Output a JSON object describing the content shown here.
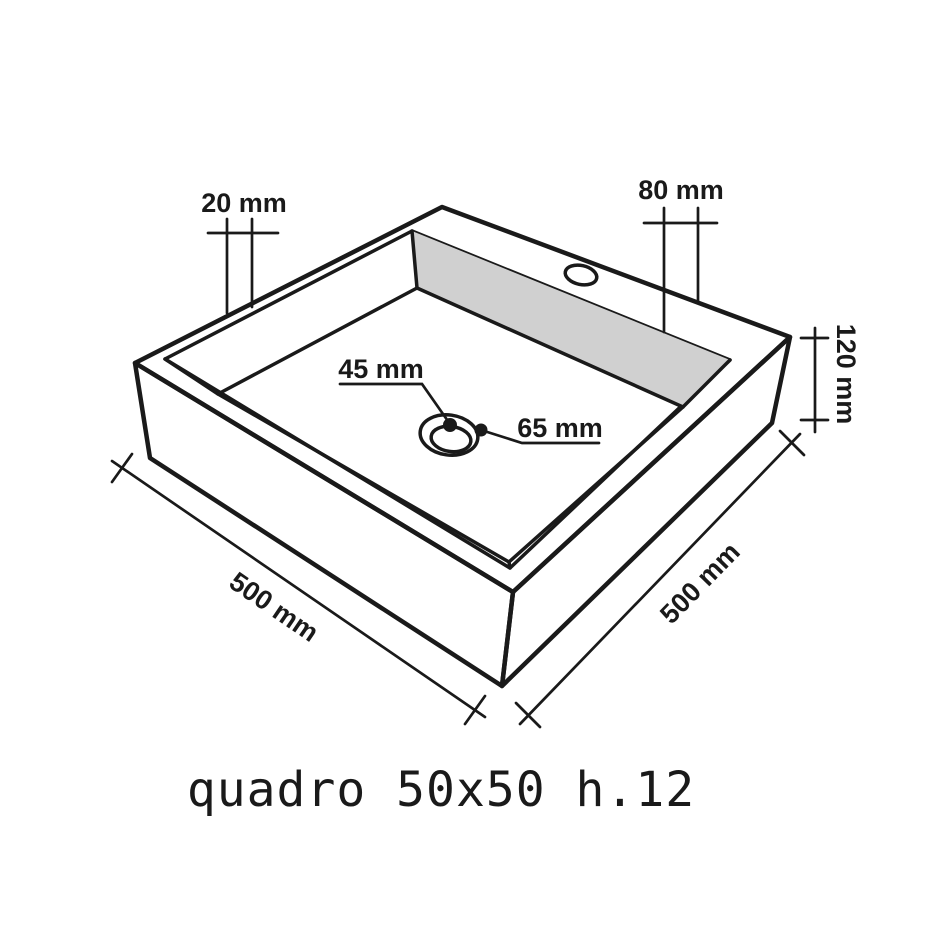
{
  "caption": "quadro 50x50 h.12",
  "labels": {
    "rim_width": "20 mm",
    "deck_width": "80 mm",
    "height": "120 mm",
    "drain_hole": "45 mm",
    "drain_flange": "65 mm",
    "side_left": "500 mm",
    "side_right": "500 mm"
  },
  "colors": {
    "line": "#1a1a1a",
    "background": "#ffffff",
    "deck_top": "#ffffff",
    "face_front_left": "#e9e9e9",
    "face_front_right": "#ffffff",
    "wall_interior": "#d8d8d8",
    "wall_interior_right": "#d0d0d0",
    "floor": "#c8c8c8",
    "drain_ring": "#ffffff",
    "drain_center": "#c2c2c2"
  }
}
